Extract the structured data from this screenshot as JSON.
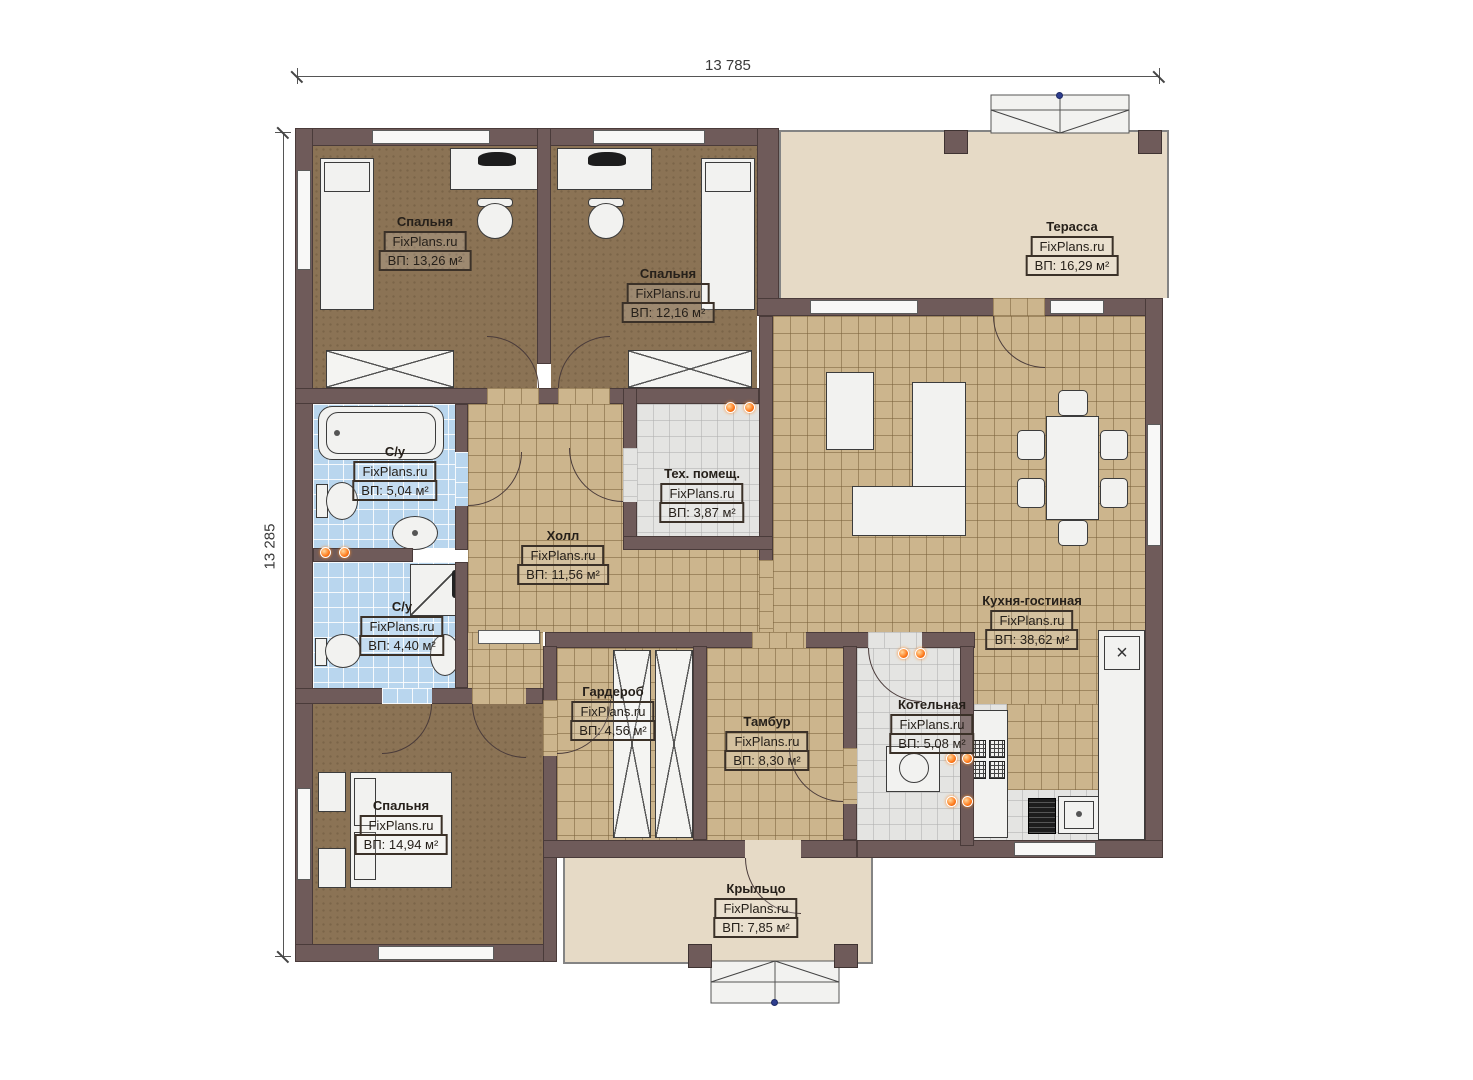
{
  "dimensions": {
    "top": "13 785",
    "left": "13 285"
  },
  "brand": "FixPlans.ru",
  "rooms": [
    {
      "key": "bedroom-1",
      "name": "Спальня",
      "brand": "FixPlans.ru",
      "area": "ВП: 13,26 м²"
    },
    {
      "key": "bedroom-2",
      "name": "Спальня",
      "brand": "FixPlans.ru",
      "area": "ВП: 12,16 м²"
    },
    {
      "key": "terrace",
      "name": "Терасса",
      "brand": "FixPlans.ru",
      "area": "ВП: 16,29 м²"
    },
    {
      "key": "bath-1",
      "name": "С/у",
      "brand": "FixPlans.ru",
      "area": "ВП: 5,04 м²"
    },
    {
      "key": "tech-room",
      "name": "Тех. помещ.",
      "brand": "FixPlans.ru",
      "area": "ВП: 3,87 м²"
    },
    {
      "key": "hall",
      "name": "Холл",
      "brand": "FixPlans.ru",
      "area": "ВП: 11,56 м²"
    },
    {
      "key": "kitchen",
      "name": "Кухня-гостиная",
      "brand": "FixPlans.ru",
      "area": "ВП: 38,62 м²"
    },
    {
      "key": "bath-2",
      "name": "С/у",
      "brand": "FixPlans.ru",
      "area": "ВП: 4,40 м²"
    },
    {
      "key": "wardrobe",
      "name": "Гардероб",
      "brand": "FixPlans.ru",
      "area": "ВП: 4,56 м²"
    },
    {
      "key": "tambour",
      "name": "Тамбур",
      "brand": "FixPlans.ru",
      "area": "ВП: 8,30 м²"
    },
    {
      "key": "boiler",
      "name": "Котельная",
      "brand": "FixPlans.ru",
      "area": "ВП: 5,08 м²"
    },
    {
      "key": "bedroom-3",
      "name": "Спальня",
      "brand": "FixPlans.ru",
      "area": "ВП: 14,94 м²"
    },
    {
      "key": "porch",
      "name": "Крыльцо",
      "brand": "FixPlans.ru",
      "area": "ВП: 7,85 м²"
    }
  ],
  "symbols": {
    "cabinet_x": "×"
  },
  "colors": {
    "wall": "#6f5b5a",
    "floor_tan": "#ccb58d",
    "floor_blue": "#b9d6ee",
    "floor_brown": "#8b7355",
    "floor_gray": "#e4e4e2",
    "floor_beige": "#e6dac6",
    "lamp": "#ff7a1a",
    "marker_blue": "#2e3e8f"
  }
}
